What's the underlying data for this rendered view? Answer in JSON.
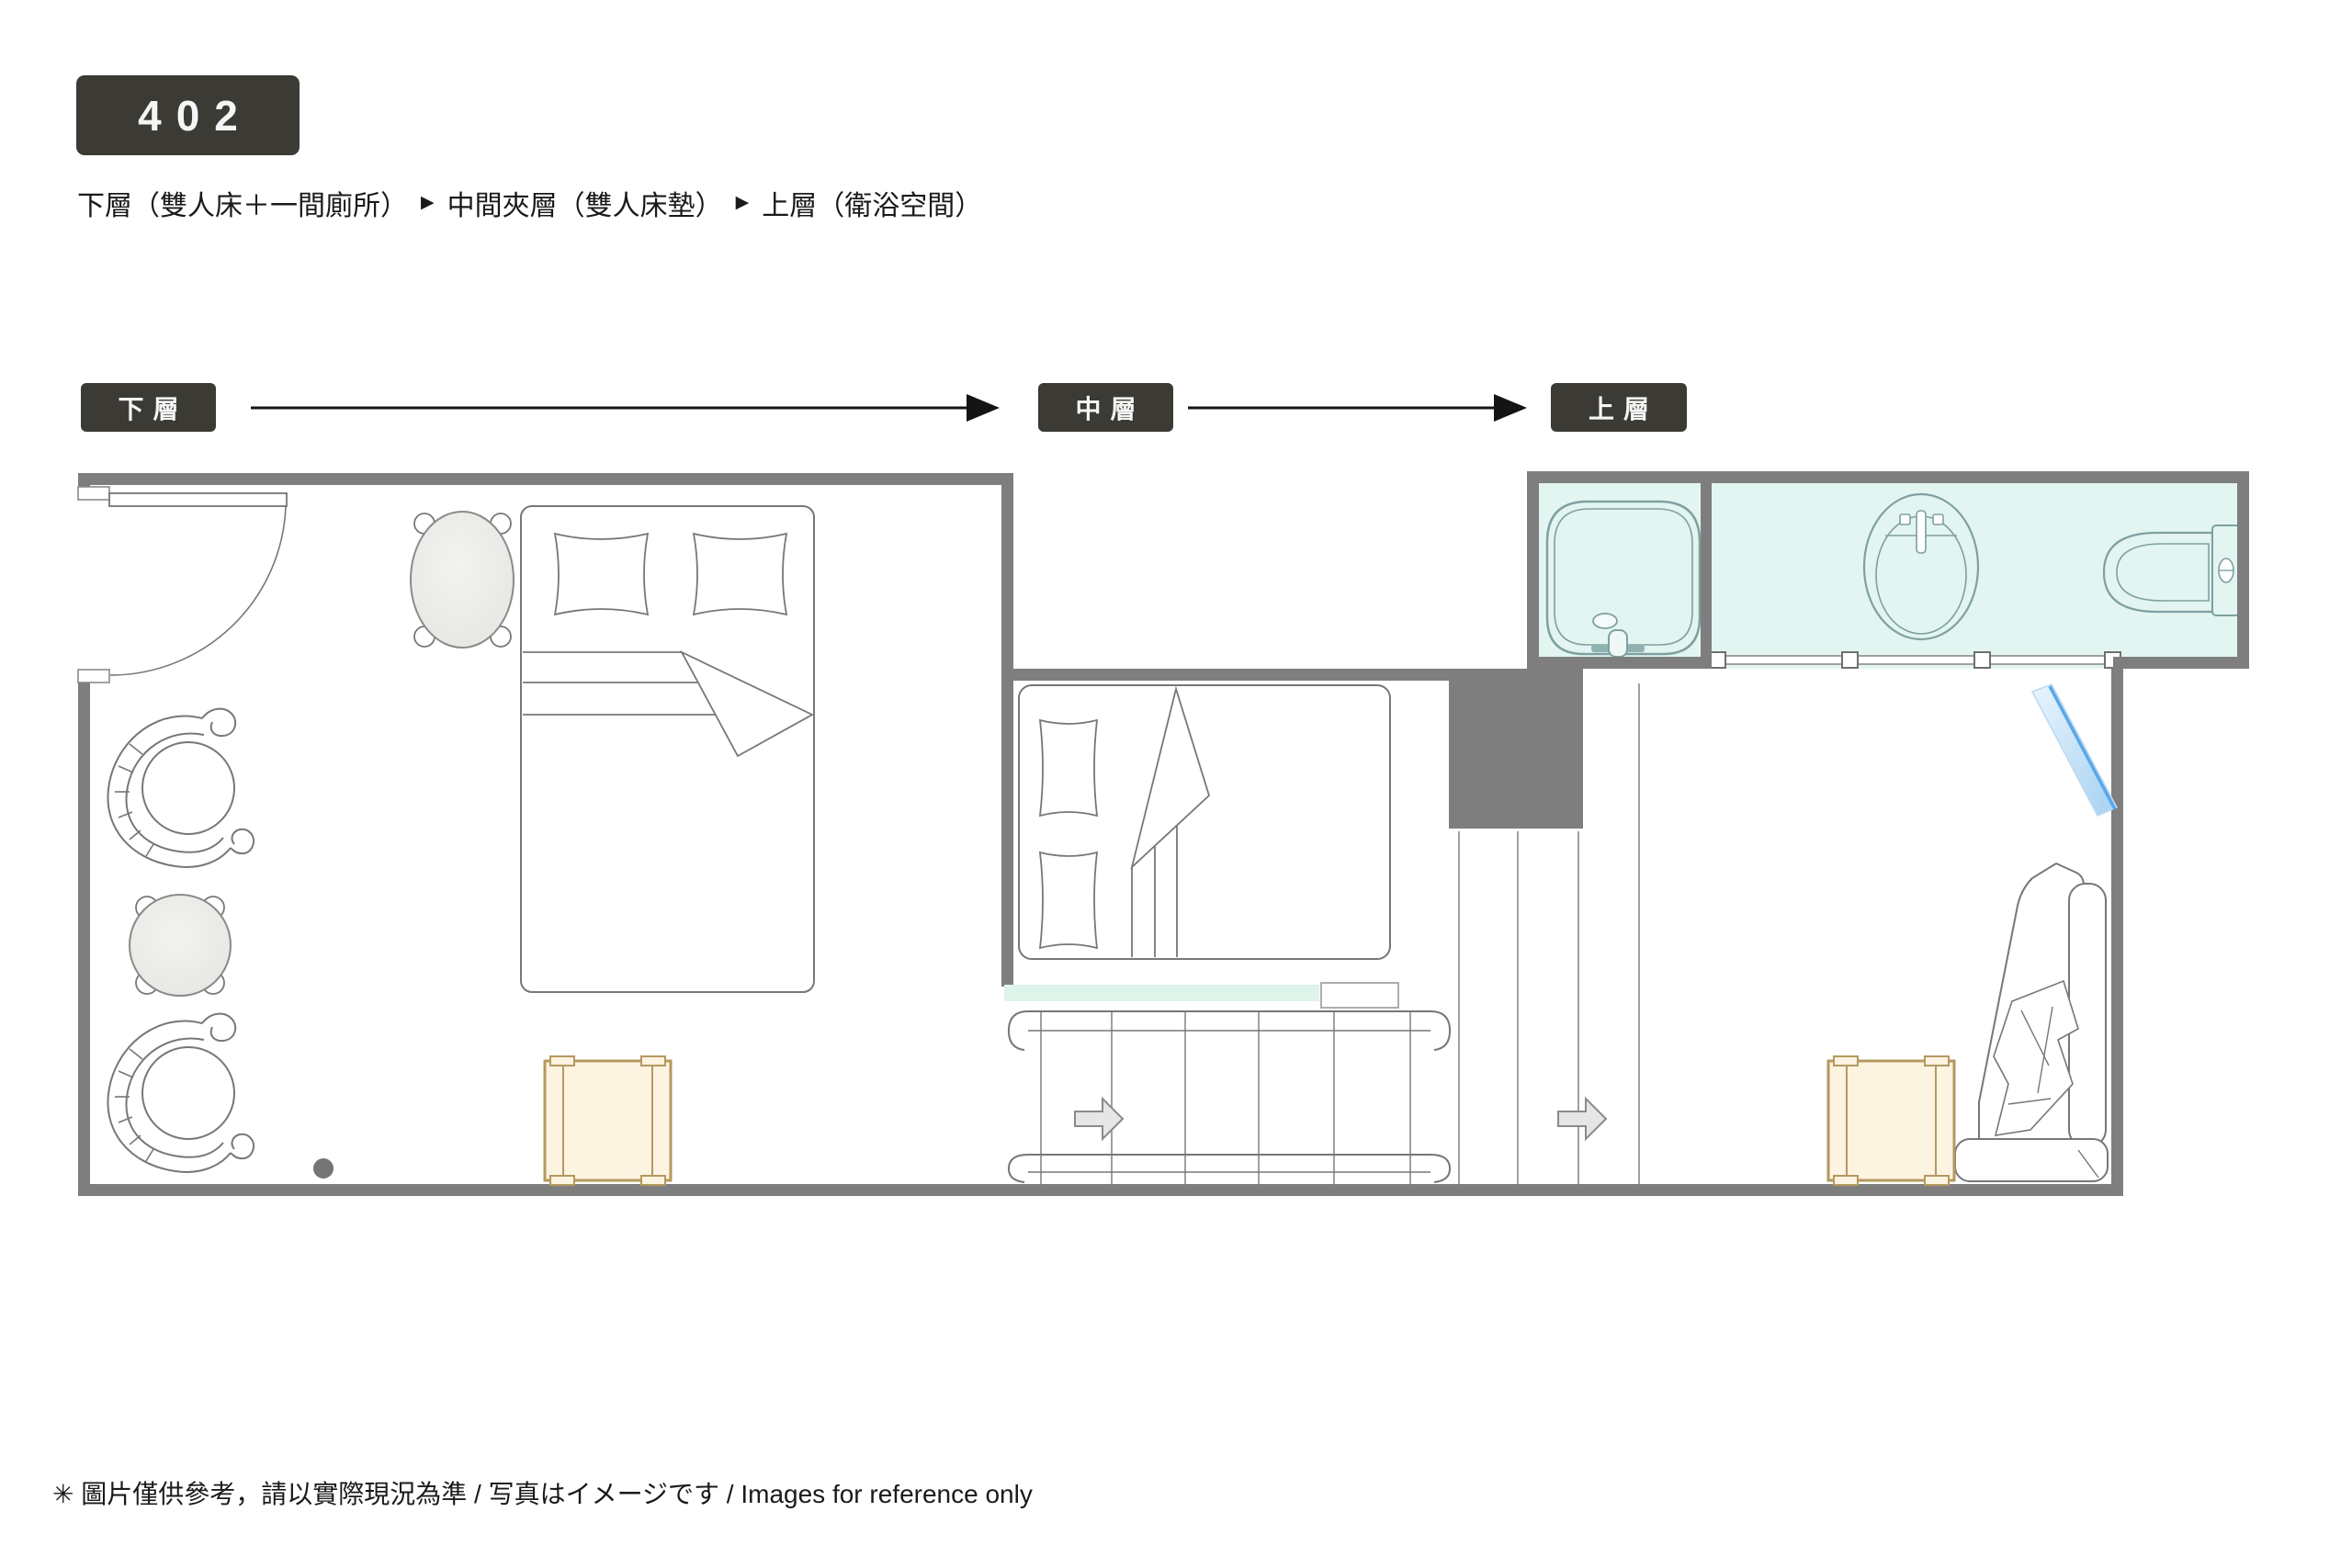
{
  "header": {
    "room_number": "402",
    "subtitle": {
      "segments": [
        "下層（雙人床＋一間廁所）",
        "中間夾層（雙人床墊）",
        "上層（衛浴空間）"
      ],
      "separator": "▶"
    }
  },
  "levels": {
    "items": [
      {
        "label": "下層"
      },
      {
        "label": "中層"
      },
      {
        "label": "上層"
      }
    ]
  },
  "floorplan": {
    "icons": [
      "entry-door",
      "double-bed",
      "pillow",
      "oval-side-table",
      "scroll-armchair",
      "round-table",
      "wooden-bench",
      "mezzanine-mattress",
      "staircase-treads",
      "handrail",
      "stair-direction-arrow",
      "bathtub",
      "washbasin",
      "toilet",
      "glass-partition",
      "mirror",
      "lounge-chaise",
      "blanket"
    ],
    "levels_shown": [
      "lower-floor",
      "middle-mezzanine",
      "upper-bathroom"
    ]
  },
  "footer": {
    "note": "✳ 圖片僅供參考，請以實際現況為準 / 写真はイメージです / Images for reference only"
  },
  "colors": {
    "badge-bg": "#3b3a34",
    "badge-text": "#f5f5f5",
    "text": "#1a1a1a",
    "wall": "#7e7e7e",
    "line": "#777777",
    "bath-fill": "#e2f5f1",
    "bath-line": "#7fa0a0",
    "mint": "#def3ea",
    "bench-fill": "#fdf3e1",
    "bench-line": "#b4995f",
    "arrow-fill": "#e6e6e6",
    "arrow-line": "#8a8a8a",
    "mirror-edge": "#59a7e8",
    "table-fill": "#ebebe9",
    "dot": "#757575"
  }
}
